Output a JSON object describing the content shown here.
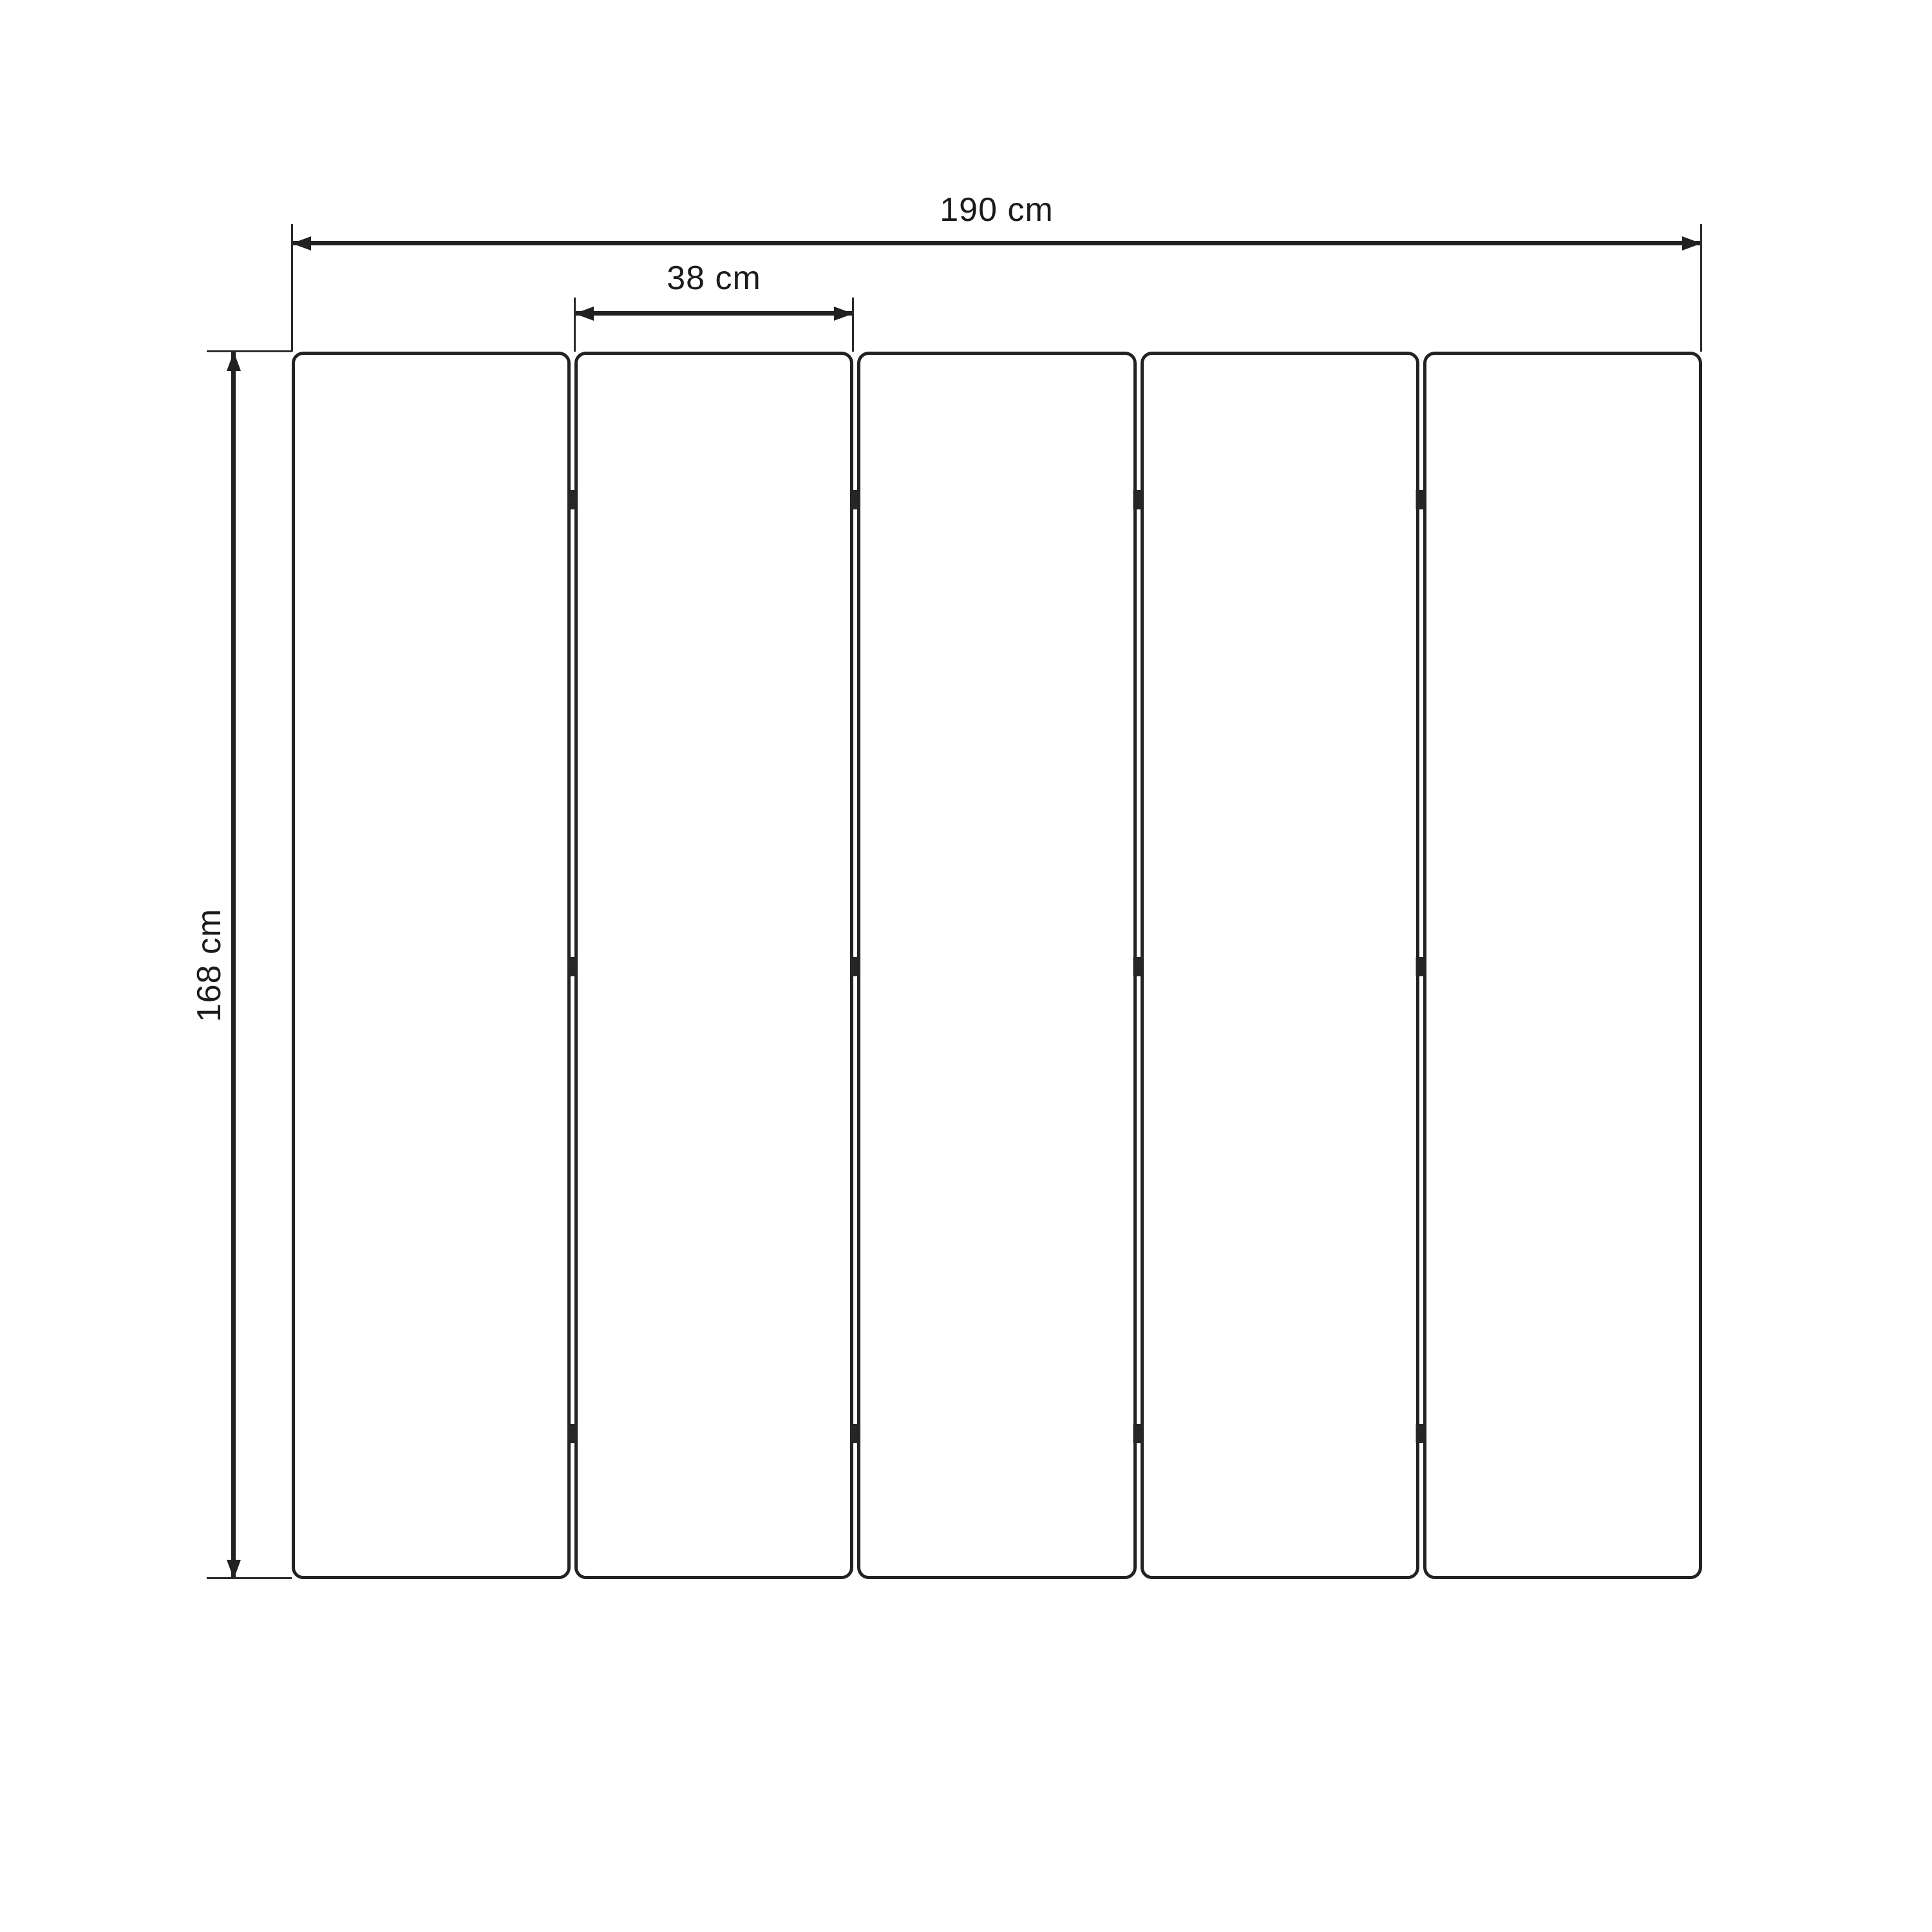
{
  "diagram": {
    "kind": "furniture-dimension-diagram",
    "subject": "five-panel folding screen front view",
    "panel_count": 5,
    "hinges_per_gap": 3,
    "labels": {
      "total_width": "190 cm",
      "panel_width": "38 cm",
      "height": "168 cm"
    },
    "values": {
      "total_width_cm": 190,
      "panel_width_cm": 38,
      "height_cm": 168
    },
    "colors": {
      "line": "#212121",
      "text": "#1b1b1b",
      "background": "#ffffff"
    }
  }
}
